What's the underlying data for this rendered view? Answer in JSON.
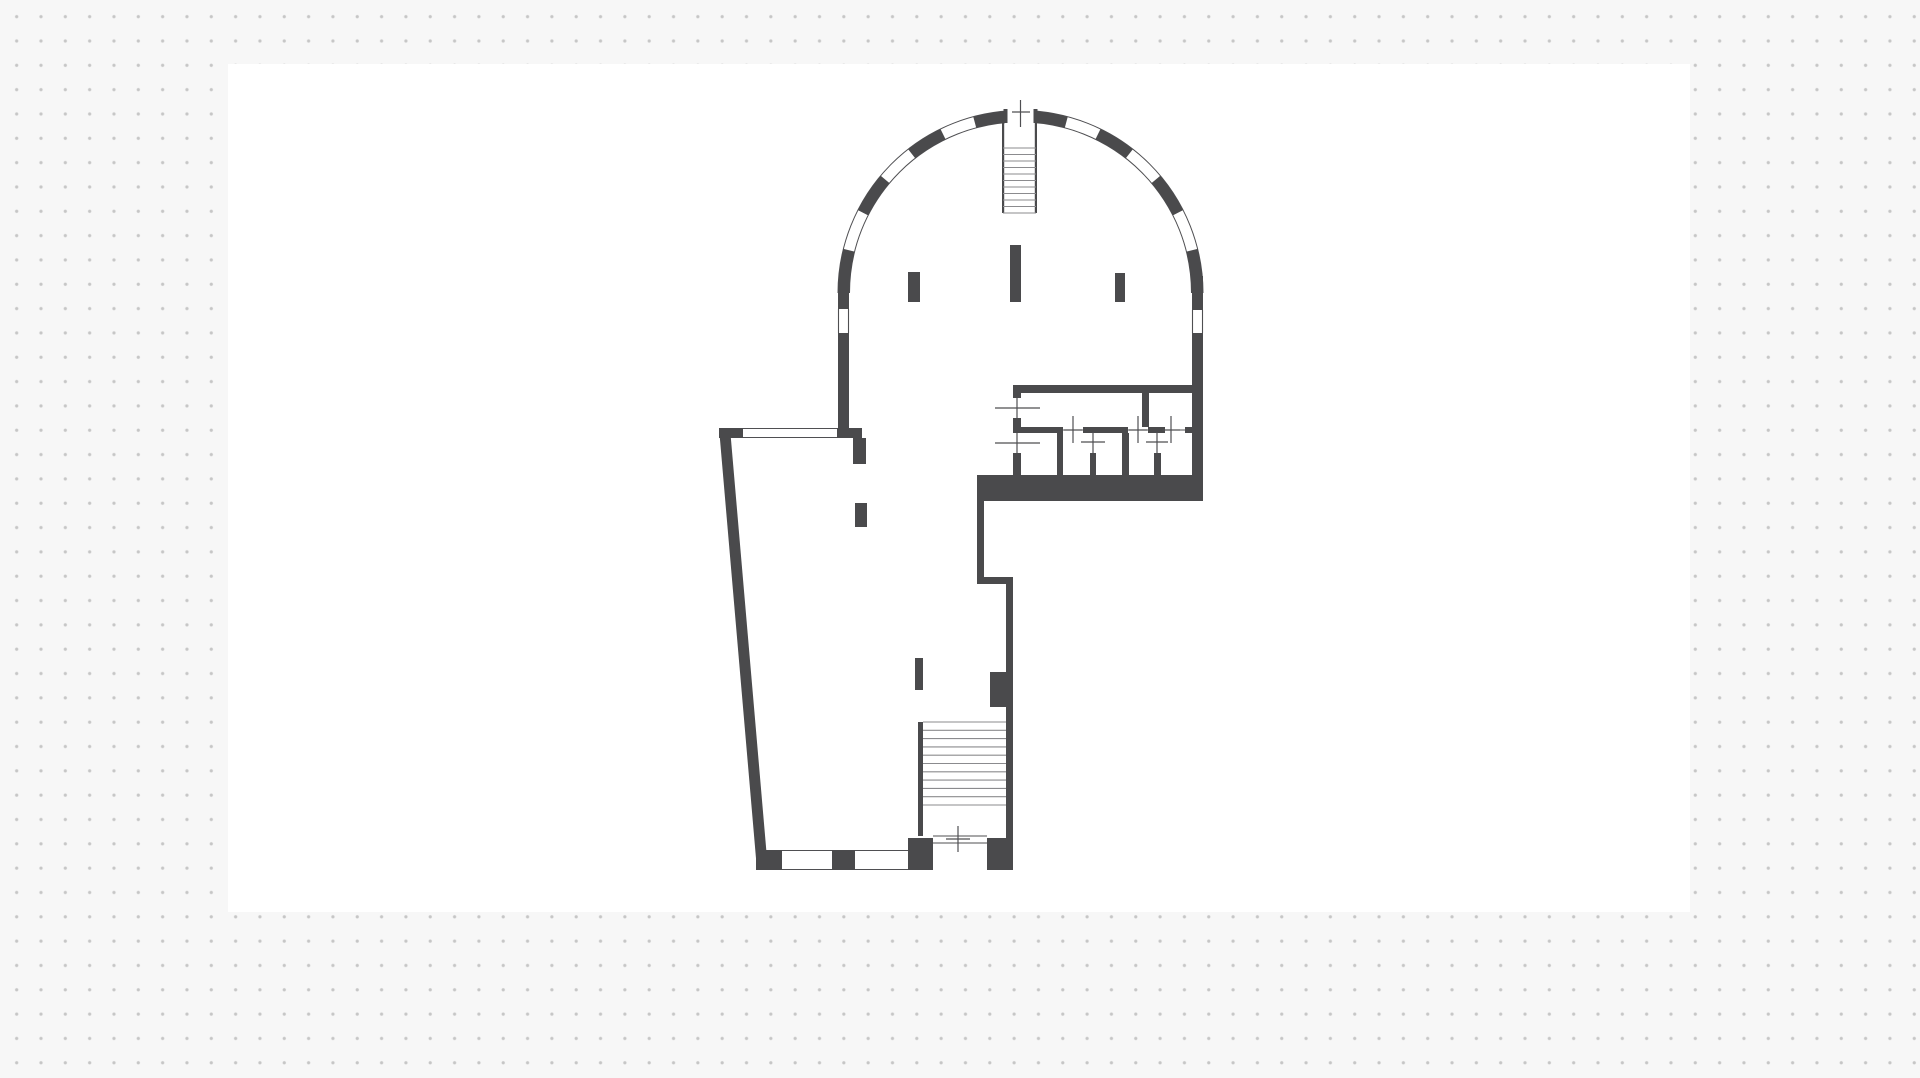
{
  "app": {
    "background_color": "#f7f7f7",
    "dot_color": "#c6c6c6",
    "dot_pitch_px": 24.33,
    "canvas": {
      "x": 228,
      "y": 64,
      "width": 1462,
      "height": 848,
      "color": "#ffffff"
    }
  },
  "floorplan": {
    "wall_color": "#4a4a4c",
    "line_color": "#4f4f52",
    "tread_color": "#8b8b8e",
    "arc": {
      "cx": 1020.5,
      "cy": 293,
      "r_outer": 182.5,
      "r_inner": 171,
      "r_mid": 176.75,
      "wall_thickness": 11.5,
      "solid_segments_deg": [
        [
          0,
          14
        ],
        [
          27,
          40
        ],
        [
          52,
          64
        ],
        [
          75,
          85.5
        ],
        [
          94.5,
          105
        ],
        [
          116,
          128
        ],
        [
          140,
          153
        ],
        [
          166,
          180
        ]
      ],
      "door": {
        "clear_rect": [
          1005,
          104,
          31,
          20
        ],
        "jamb_rects": [
          [
            1003.5,
            109,
            4,
            14
          ],
          [
            1033.5,
            109,
            4,
            14
          ]
        ]
      }
    },
    "walls": [
      [
        838,
        293,
        11,
        16
      ],
      [
        838,
        333,
        11,
        105
      ],
      [
        1192,
        276,
        11,
        34
      ],
      [
        1192,
        333,
        11,
        168
      ],
      [
        719,
        428,
        24,
        10
      ],
      [
        837,
        428,
        25,
        10
      ],
      [
        853,
        438,
        13,
        26
      ],
      [
        1021,
        385,
        171,
        8
      ],
      [
        1013,
        385,
        8,
        13
      ],
      [
        1013,
        418,
        8,
        15
      ],
      [
        1013,
        453,
        8,
        24
      ],
      [
        1021,
        427,
        42,
        6
      ],
      [
        1083,
        427,
        45,
        6
      ],
      [
        1148,
        427,
        17,
        6
      ],
      [
        1185,
        427,
        7,
        6
      ],
      [
        1142,
        393,
        7,
        34
      ],
      [
        1057,
        433,
        6,
        44
      ],
      [
        1090,
        453,
        6,
        24
      ],
      [
        1122,
        433,
        7,
        44
      ],
      [
        1154,
        453,
        7,
        24
      ],
      [
        977,
        475,
        226,
        26
      ],
      [
        977,
        501,
        7,
        83
      ],
      [
        977,
        577,
        36,
        7
      ],
      [
        1006,
        584,
        7,
        286
      ],
      [
        990,
        672,
        16,
        35
      ],
      [
        918,
        722,
        5,
        114
      ],
      [
        756,
        850,
        26,
        20
      ],
      [
        832,
        850,
        23,
        20
      ],
      [
        908,
        838,
        25,
        32
      ],
      [
        987,
        838,
        26,
        32
      ]
    ],
    "wall_stubs": [
      [
        908,
        272,
        12,
        30
      ],
      [
        1010,
        245,
        11,
        57
      ],
      [
        1115,
        273,
        10,
        29
      ],
      [
        855,
        503,
        12,
        24
      ],
      [
        915,
        658,
        8,
        32
      ]
    ],
    "slanted_wall_polygon": [
      [
        719,
        428
      ],
      [
        730,
        428
      ],
      [
        768,
        870
      ],
      [
        757,
        870
      ]
    ],
    "windows": [
      {
        "o": "h",
        "x1": 743,
        "x2": 837,
        "y1": 428.5,
        "y2": 437.5
      },
      {
        "o": "h",
        "x1": 782,
        "x2": 832,
        "y1": 850.5,
        "y2": 869.5
      },
      {
        "o": "h",
        "x1": 855,
        "x2": 908,
        "y1": 850.5,
        "y2": 869.5
      },
      {
        "o": "v",
        "x1": 838.5,
        "x2": 848.5,
        "y1": 309,
        "y2": 333
      },
      {
        "o": "v",
        "x1": 1192.5,
        "x2": 1202.5,
        "y1": 310,
        "y2": 333
      }
    ],
    "stairs": [
      {
        "x1": 1003,
        "x2": 1036,
        "y1": 148,
        "y2": 213,
        "treads": 11,
        "rails": [
          [
            1002,
            121,
            2.2,
            92
          ],
          [
            1034.8,
            121,
            2.2,
            92
          ]
        ]
      },
      {
        "x1": 923,
        "x2": 1006,
        "y1": 722,
        "y2": 805,
        "treads": 11,
        "rails": []
      }
    ],
    "door_leaf_lines": [
      {
        "o": "v",
        "x": 1017,
        "y1": 398,
        "y2": 418
      },
      {
        "o": "v",
        "x": 1017,
        "y1": 433,
        "y2": 453
      },
      {
        "o": "h",
        "y": 430,
        "x1": 1063,
        "x2": 1083
      },
      {
        "o": "h",
        "y": 430,
        "x1": 1128,
        "x2": 1148
      },
      {
        "o": "h",
        "y": 430,
        "x1": 1165,
        "x2": 1185
      },
      {
        "o": "h",
        "y": 836,
        "x1": 933,
        "x2": 987
      },
      {
        "o": "h",
        "y": 843,
        "x1": 933,
        "x2": 987
      }
    ],
    "door_tick_crosses": [
      {
        "h": [
          995,
          1040,
          408
        ],
        "v": [
          1017,
          398,
          418
        ]
      },
      {
        "h": [
          995,
          1040,
          443
        ],
        "v": [
          1017,
          433,
          453
        ]
      },
      {
        "h": [
          1064,
          1082,
          430
        ],
        "v": [
          1073,
          416,
          443
        ]
      },
      {
        "h": [
          1081,
          1105,
          442
        ],
        "v": [
          1093,
          432,
          453
        ]
      },
      {
        "h": [
          1129,
          1147,
          430
        ],
        "v": [
          1138,
          416,
          443
        ]
      },
      {
        "h": [
          1146,
          1168,
          442
        ],
        "v": [
          1157,
          432,
          453
        ]
      },
      {
        "h": [
          1162,
          1180,
          430
        ],
        "v": [
          1171,
          416,
          443
        ]
      },
      {
        "h": [
          1012,
          1030,
          112
        ],
        "v": [
          1020.5,
          100,
          127
        ]
      },
      {
        "h": [
          946,
          970,
          839
        ],
        "v": [
          958,
          826,
          852
        ]
      }
    ]
  }
}
